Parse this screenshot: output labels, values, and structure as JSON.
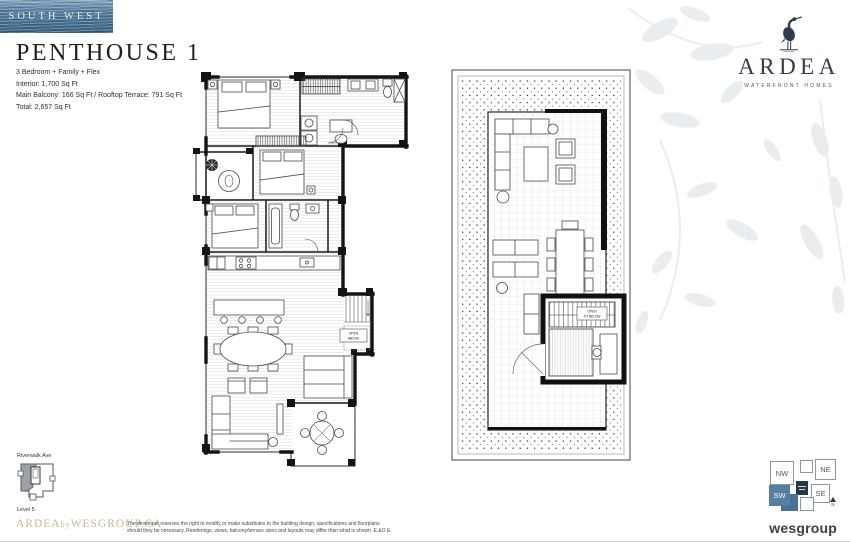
{
  "colors": {
    "accent_tan": "#c8b49a",
    "brand_navy": "#323d4f",
    "compass_blue": "#567ea0",
    "water_banner_blue": "#4f7a9b",
    "plan_ink": "#161616"
  },
  "header": {
    "banner_label": "SOUTH WEST",
    "title": "PENTHOUSE 1",
    "specs": [
      "3 Bedroom + Family + Flex",
      "Interior: 1,700 Sq Ft",
      "Main Balcony: 166 Sq Ft / Rooftop Terrace: 791 Sq Ft",
      "Total: 2,657 Sq Ft"
    ]
  },
  "brand": {
    "name": "ARDEA",
    "tagline": "WATERFRONT HOMES"
  },
  "floorplans": {
    "main": {
      "open_label": [
        "OPEN",
        "ABOVE"
      ]
    },
    "rooftop": {
      "open_label": [
        "OPEN",
        "TO BELOW"
      ]
    }
  },
  "keyplan": {
    "street": "Riverwalk Ave",
    "level": "Level 5"
  },
  "compass": {
    "nw": "NW",
    "ne": "NE",
    "sw": "SW",
    "se": "SE",
    "north": "N"
  },
  "footer": {
    "website_brand": "ARDEA",
    "website_by": "by",
    "website_rest": "WESGROUP.CA",
    "disclaimer": [
      "The developer reserves the right to modify or make substitutes to the building design, specifications and floorplans",
      "should they be necessary. Renderings, views, balcony/terrace sizes and layouts may differ than what is shown. E.&O.E."
    ],
    "developer": "wesgroup"
  }
}
